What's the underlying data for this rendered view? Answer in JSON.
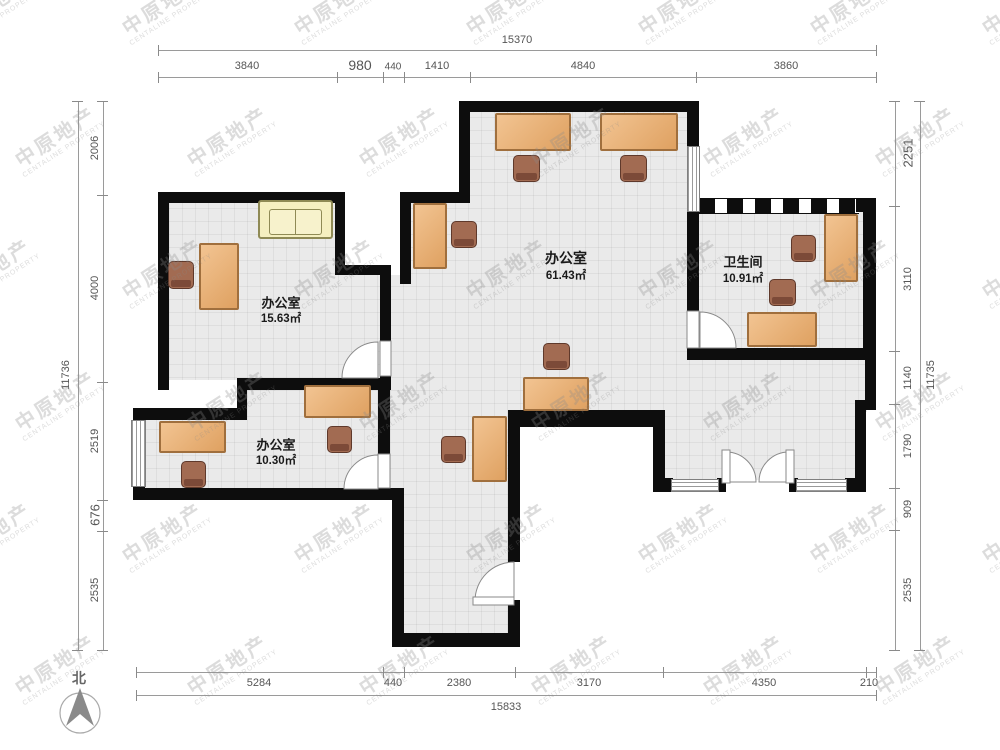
{
  "watermark": {
    "line1": "中原地产",
    "line2": "CENTALINE PROPERTY"
  },
  "compass": {
    "label": "北"
  },
  "rooms": {
    "main": {
      "name": "办公室",
      "area": "61.43㎡"
    },
    "west": {
      "name": "办公室",
      "area": "15.63㎡"
    },
    "south": {
      "name": "办公室",
      "area": "10.30㎡"
    },
    "bath": {
      "name": "卫生间",
      "area": "10.91㎡"
    }
  },
  "dims": {
    "top": {
      "total": "15370",
      "segs": [
        "3840",
        "980",
        "440",
        "1410",
        "4840",
        "3860"
      ]
    },
    "bottom": {
      "total": "15833",
      "segs": [
        "5284",
        "440",
        "2380",
        "3170",
        "4350",
        "210"
      ]
    },
    "left": {
      "total": "11736",
      "segs": [
        "2006",
        "4000",
        "2519",
        "676",
        "2535"
      ]
    },
    "right": {
      "total": "11735",
      "segs": [
        "2251",
        "3110",
        "1140",
        "1790",
        "909",
        "2535"
      ]
    }
  },
  "colors": {
    "wall": "#0d0d0d",
    "floor": "#eaeaea",
    "desk": "#e8b077",
    "chair": "#96604b",
    "sofa": "#f4eec2",
    "dim_text": "#555555"
  }
}
